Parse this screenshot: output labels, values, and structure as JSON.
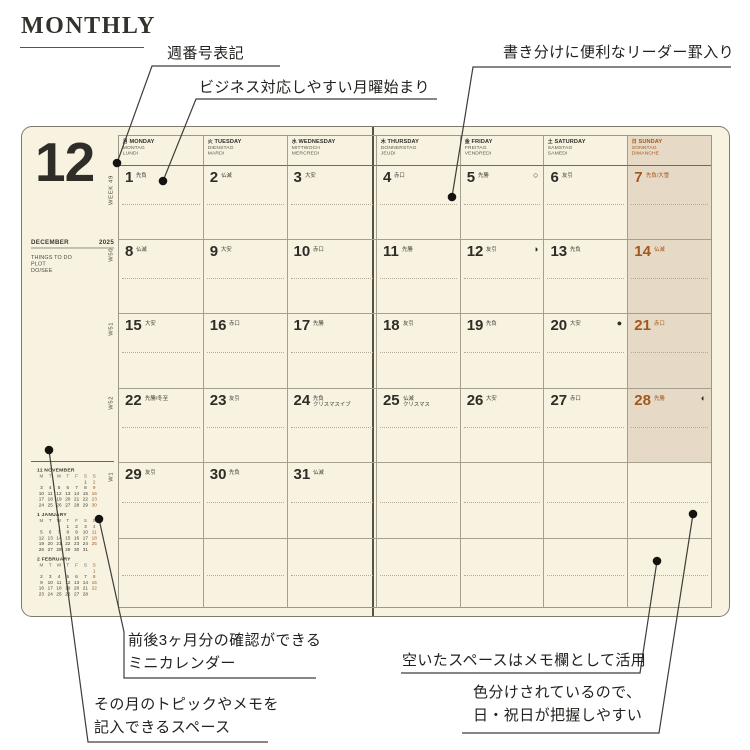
{
  "page_title": "MONTHLY",
  "annotations": {
    "week_number": {
      "text": "週番号表記"
    },
    "monday_start": {
      "text": "ビジネス対応しやすい月曜始まり"
    },
    "leader_rule": {
      "text": "書き分けに便利なリーダー罫入り"
    },
    "mini_calendar": {
      "line1": "前後3ヶ月分の確認ができる",
      "line2": "ミニカレンダー"
    },
    "topic_space": {
      "line1": "その月のトピックやメモを",
      "line2": "記入できるスペース"
    },
    "memo_space": {
      "text": "空いたスペースはメモ欄として活用"
    },
    "color_coding": {
      "line1": "色分けされているので、",
      "line2": "日・祝日が把握しやすい"
    }
  },
  "info_panel": {
    "month_number": "12",
    "month_name": "DECEMBER",
    "year": "2025",
    "todo_lines": [
      "THINGS TO DO",
      "PLOT",
      "DO/SEE"
    ]
  },
  "calendar": {
    "week_labels": [
      "WEEK 49",
      "W50",
      "W51",
      "W52",
      "W1"
    ],
    "weekdays": [
      {
        "kanji": "月",
        "en": "MONDAY",
        "de": "MONTAG",
        "fr": "LUNDI"
      },
      {
        "kanji": "火",
        "en": "TUESDAY",
        "de": "DIENSTAG",
        "fr": "MARDI"
      },
      {
        "kanji": "水",
        "en": "WEDNESDAY",
        "de": "MITTWOCH",
        "fr": "MERCREDI"
      },
      {
        "kanji": "木",
        "en": "THURSDAY",
        "de": "DONNERSTAG",
        "fr": "JEUDI"
      },
      {
        "kanji": "金",
        "en": "FRIDAY",
        "de": "FREITAG",
        "fr": "VENDREDI"
      },
      {
        "kanji": "土",
        "en": "SATURDAY",
        "de": "SAMSTAG",
        "fr": "SAMEDI"
      },
      {
        "kanji": "日",
        "en": "SUNDAY",
        "de": "SONNTAG",
        "fr": "DIMANCHE"
      }
    ],
    "weeks": [
      [
        {
          "d": "1",
          "r": "先負"
        },
        {
          "d": "2",
          "r": "仏滅"
        },
        {
          "d": "3",
          "r": "大安"
        },
        {
          "d": "4",
          "r": "赤口"
        },
        {
          "d": "5",
          "r": "先勝",
          "moon": "○"
        },
        {
          "d": "6",
          "r": "友引"
        },
        {
          "d": "7",
          "r": "先負/大雪"
        }
      ],
      [
        {
          "d": "8",
          "r": "仏滅"
        },
        {
          "d": "9",
          "r": "大安"
        },
        {
          "d": "10",
          "r": "赤口"
        },
        {
          "d": "11",
          "r": "先勝"
        },
        {
          "d": "12",
          "r": "友引",
          "moon": "◑"
        },
        {
          "d": "13",
          "r": "先負"
        },
        {
          "d": "14",
          "r": "仏滅"
        }
      ],
      [
        {
          "d": "15",
          "r": "大安"
        },
        {
          "d": "16",
          "r": "赤口"
        },
        {
          "d": "17",
          "r": "先勝"
        },
        {
          "d": "18",
          "r": "友引"
        },
        {
          "d": "19",
          "r": "先負"
        },
        {
          "d": "20",
          "r": "大安",
          "moon": "●"
        },
        {
          "d": "21",
          "r": "赤口"
        }
      ],
      [
        {
          "d": "22",
          "r": "先勝/冬至"
        },
        {
          "d": "23",
          "r": "友引"
        },
        {
          "d": "24",
          "r": "先負",
          "note": "クリスマスイブ"
        },
        {
          "d": "25",
          "r": "仏滅",
          "note": "クリスマス"
        },
        {
          "d": "26",
          "r": "大安"
        },
        {
          "d": "27",
          "r": "赤口"
        },
        {
          "d": "28",
          "r": "先勝",
          "moon": "◐"
        }
      ],
      [
        {
          "d": "29",
          "r": "友引"
        },
        {
          "d": "30",
          "r": "先負"
        },
        {
          "d": "31",
          "r": "仏滅"
        },
        {},
        {},
        {},
        {}
      ],
      [
        {},
        {},
        {},
        {},
        {},
        {},
        {}
      ]
    ]
  },
  "mini_calendars": [
    {
      "title": "11 NOVEMBER",
      "weekdays": [
        "M",
        "T",
        "W",
        "T",
        "F",
        "S",
        "S"
      ],
      "rows": [
        [
          "",
          "",
          "",
          "",
          "",
          "1",
          "2"
        ],
        [
          "3",
          "4",
          "5",
          "6",
          "7",
          "8",
          "9"
        ],
        [
          "10",
          "11",
          "12",
          "13",
          "14",
          "15",
          "16"
        ],
        [
          "17",
          "18",
          "19",
          "20",
          "21",
          "22",
          "23"
        ],
        [
          "24",
          "25",
          "26",
          "27",
          "28",
          "29",
          "30"
        ]
      ]
    },
    {
      "title": "1 JANUARY",
      "weekdays": [
        "M",
        "T",
        "W",
        "T",
        "F",
        "S",
        "S"
      ],
      "rows": [
        [
          "",
          "",
          "",
          "1",
          "2",
          "3",
          "4"
        ],
        [
          "5",
          "6",
          "7",
          "8",
          "9",
          "10",
          "11"
        ],
        [
          "12",
          "13",
          "14",
          "15",
          "16",
          "17",
          "18"
        ],
        [
          "19",
          "20",
          "21",
          "22",
          "23",
          "24",
          "25"
        ],
        [
          "26",
          "27",
          "28",
          "29",
          "30",
          "31",
          ""
        ]
      ]
    },
    {
      "title": "2 FEBRUARY",
      "weekdays": [
        "M",
        "T",
        "W",
        "T",
        "F",
        "S",
        "S"
      ],
      "rows": [
        [
          "",
          "",
          "",
          "",
          "",
          "",
          "1"
        ],
        [
          "2",
          "3",
          "4",
          "5",
          "6",
          "7",
          "8"
        ],
        [
          "9",
          "10",
          "11",
          "12",
          "13",
          "14",
          "15"
        ],
        [
          "16",
          "17",
          "18",
          "19",
          "20",
          "21",
          "22"
        ],
        [
          "23",
          "24",
          "25",
          "26",
          "27",
          "28",
          ""
        ]
      ]
    }
  ],
  "colors": {
    "cream": "#f7f3e0",
    "tan": "#e6d9c5",
    "sun": "#a2571c",
    "ink": "#2e2d28",
    "line": "#a59f8e",
    "fold": "#57534a"
  }
}
